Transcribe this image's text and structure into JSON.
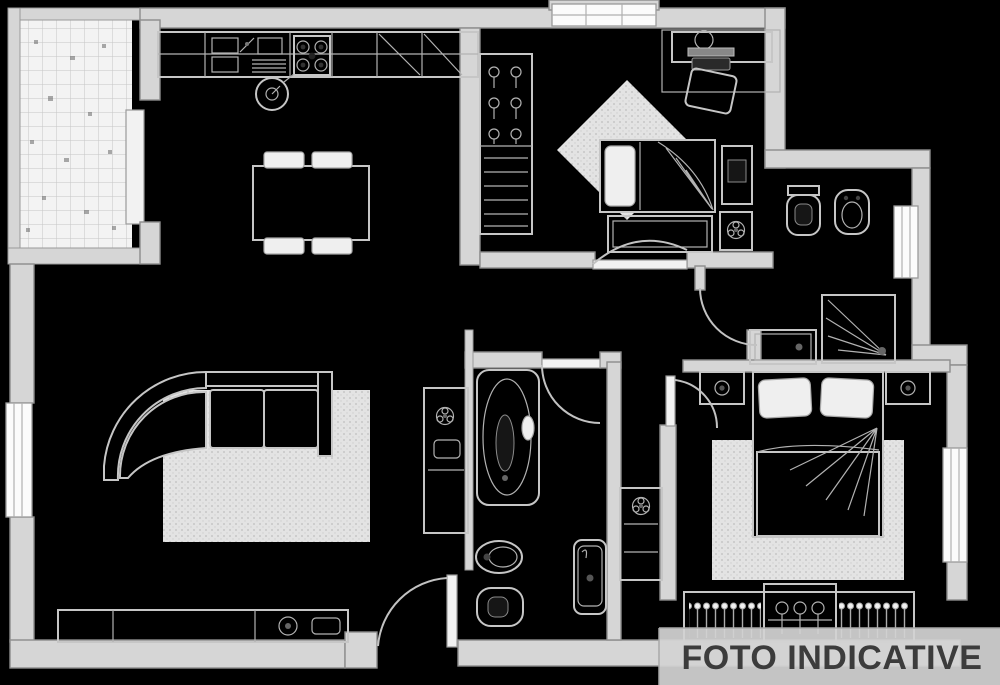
{
  "watermark": {
    "label": "FOTO INDICATIVE",
    "bar_color": "#d3d3d3",
    "text_color": "#3c3c3c"
  },
  "palette": {
    "background": "#000000",
    "wall_fill": "#d6d6d6",
    "wall_outline": "#8d8d8d",
    "furniture_line": "#c6c6c6",
    "rug_fill": "#e3e3e3",
    "tile_fill": "#f3f3f3",
    "window_fill": "#fbfbfb"
  },
  "floorplan": {
    "type": "apartment-floor-plan",
    "rooms": [
      {
        "name": "terrace",
        "features": [
          "tiled-floor",
          "sliding-door"
        ]
      },
      {
        "name": "kitchen",
        "features": [
          "sink-unit",
          "dish-drainer",
          "stove-4-burners",
          "counter-cabinets",
          "dining-table",
          "four-chairs",
          "moka-pot"
        ]
      },
      {
        "name": "living-room",
        "features": [
          "corner-sofa",
          "rug",
          "sideboard",
          "tv",
          "plant-cabinet",
          "window",
          "entrance-door"
        ]
      },
      {
        "name": "bedroom-1",
        "features": [
          "wardrobe-hangers-shelves",
          "single-bed",
          "nightstand",
          "plant-table",
          "dresser",
          "desk",
          "laptop",
          "desk-chair",
          "rug",
          "top-window"
        ]
      },
      {
        "name": "bathroom-1",
        "features": [
          "toilet",
          "bidet",
          "shower",
          "washbasin",
          "window"
        ]
      },
      {
        "name": "hallway",
        "features": [
          "storage-cabinet",
          "washbasin",
          "door-arcs"
        ]
      },
      {
        "name": "bathroom-2",
        "features": [
          "bathtub",
          "bidet",
          "toilet"
        ]
      },
      {
        "name": "bedroom-2",
        "features": [
          "double-bed",
          "nightstand-left-lamp",
          "nightstand-right-lamp",
          "rug",
          "wardrobe-hangers",
          "window"
        ]
      }
    ],
    "entrance": "bottom-center-door-with-swing-arc"
  }
}
